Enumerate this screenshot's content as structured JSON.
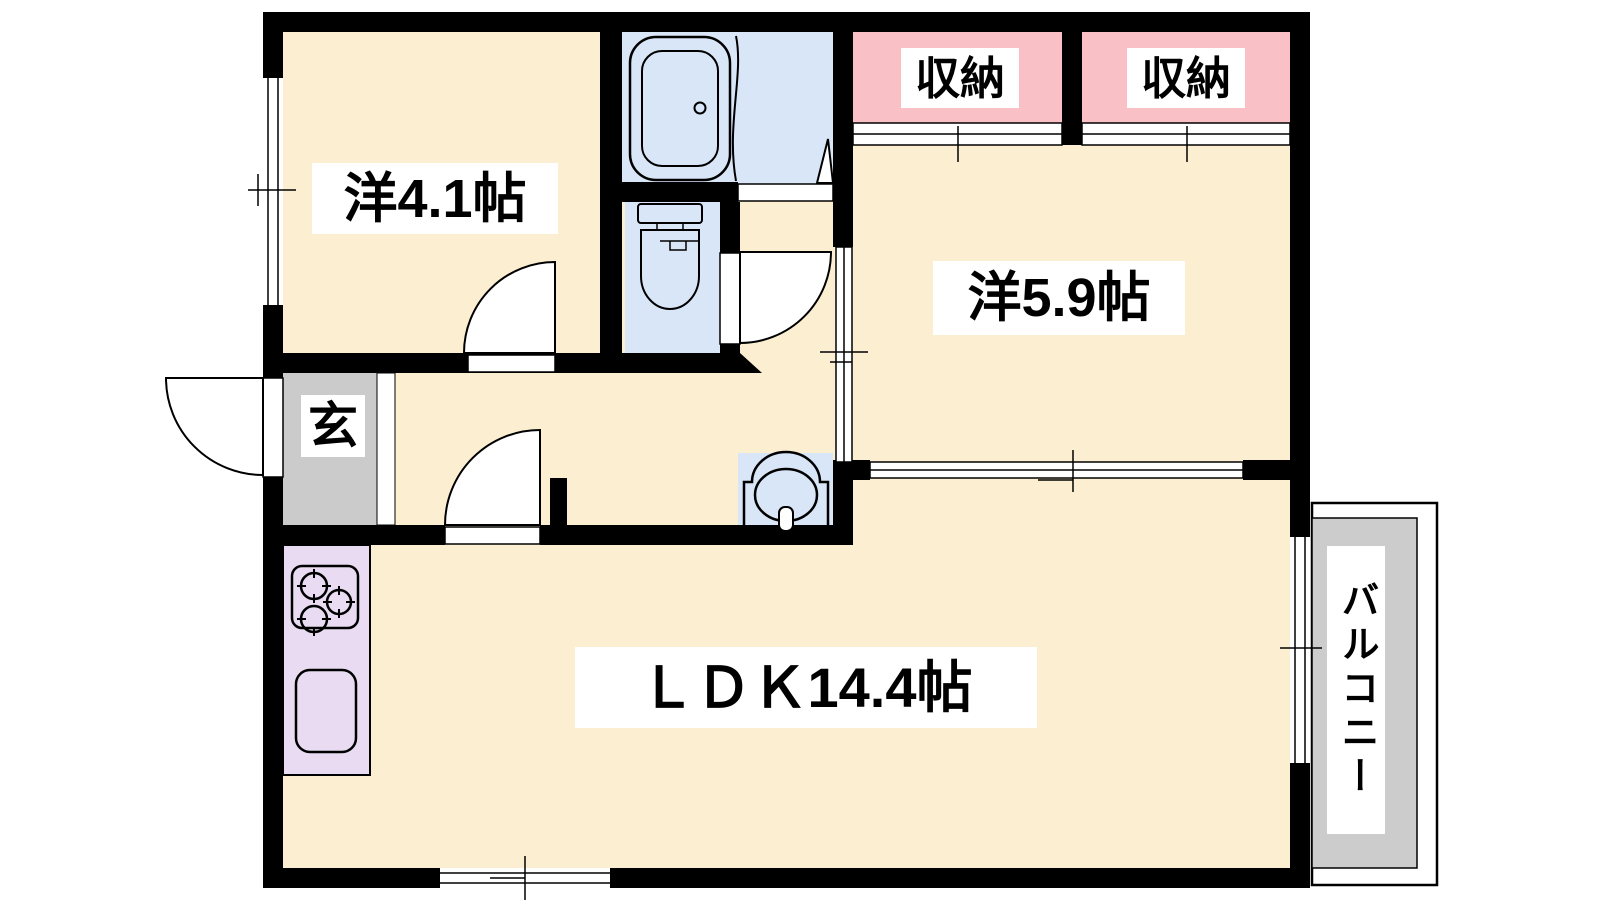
{
  "colors": {
    "paper": "#ffffff",
    "wall": "#000000",
    "outline": "#000000",
    "floor": "#fbeed1",
    "wet": "#d9e6f8",
    "closet": "#f9c1c6",
    "genkan": "#cbcbcb",
    "balcony": "#cccccc",
    "kitchen": "#e9dcf2"
  },
  "labels": {
    "room_4_1": "洋4.1帖",
    "room_5_9": "洋5.9帖",
    "ldk": "ＬＤＫ14.4帖",
    "closet_left": "収納",
    "closet_right": "収納",
    "genkan": "玄",
    "balcony": "バルコニー"
  }
}
